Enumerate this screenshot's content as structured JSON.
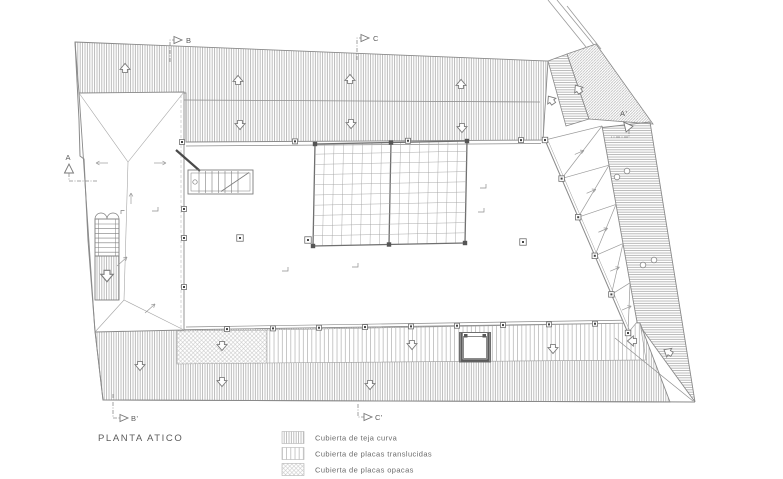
{
  "title": {
    "text": "PLANTA ATICO"
  },
  "legend": {
    "items": [
      {
        "name": "teja-curva",
        "label": "Cubierta de teja curva"
      },
      {
        "name": "placas-translucidas",
        "label": "Cubierta de placas translucidas"
      },
      {
        "name": "placas-opacas",
        "label": "Cubierta de placas opacas"
      }
    ]
  },
  "section_markers": {
    "b": {
      "label": "B"
    },
    "c": {
      "label": "C"
    },
    "a": {
      "label": "A"
    },
    "a_prime": {
      "label": "A'"
    },
    "b_prime": {
      "label": "B'"
    },
    "c_prime": {
      "label": "C'"
    }
  },
  "colors": {
    "drawing_line": "#8a8a8a",
    "hatch_line": "#b0b0b0",
    "text": "#5c5c5c",
    "background": "#ffffff"
  }
}
